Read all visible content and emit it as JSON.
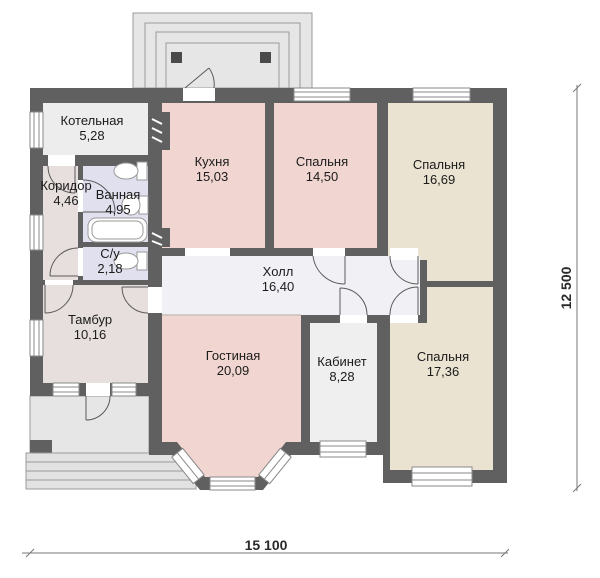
{
  "rooms": [
    {
      "id": "boiler",
      "name": "Котельная",
      "area": "5,28"
    },
    {
      "id": "corridor",
      "name": "Коридор",
      "area": "4,46"
    },
    {
      "id": "bathroom",
      "name": "Ванная",
      "area": "4,95"
    },
    {
      "id": "wc",
      "name": "С/у",
      "area": "2,18"
    },
    {
      "id": "vestibule",
      "name": "Тамбур",
      "area": "10,16"
    },
    {
      "id": "kitchen",
      "name": "Кухня",
      "area": "15,03"
    },
    {
      "id": "bedroom1",
      "name": "Спальня",
      "area": "14,50"
    },
    {
      "id": "bedroom2",
      "name": "Спальня",
      "area": "16,69"
    },
    {
      "id": "hall",
      "name": "Холл",
      "area": "16,40"
    },
    {
      "id": "living",
      "name": "Гостиная",
      "area": "20,09"
    },
    {
      "id": "office",
      "name": "Кабинет",
      "area": "8,28"
    },
    {
      "id": "bedroom3",
      "name": "Спальня",
      "area": "17,36"
    }
  ],
  "dimensions": {
    "bottom": "15 100",
    "right": "12 500"
  },
  "colors": {
    "wall": "#606060",
    "room_pink": "#f1d5d1",
    "room_beige": "#eae3d1",
    "room_service_gray": "#ededed",
    "room_warm_gray": "#e7dfdd",
    "room_sanitary": "#e0e0ef",
    "hall": "#f1f0f4",
    "office": "#efefef",
    "porch": "#e6e6e6",
    "outline": "#9a9a9a"
  }
}
